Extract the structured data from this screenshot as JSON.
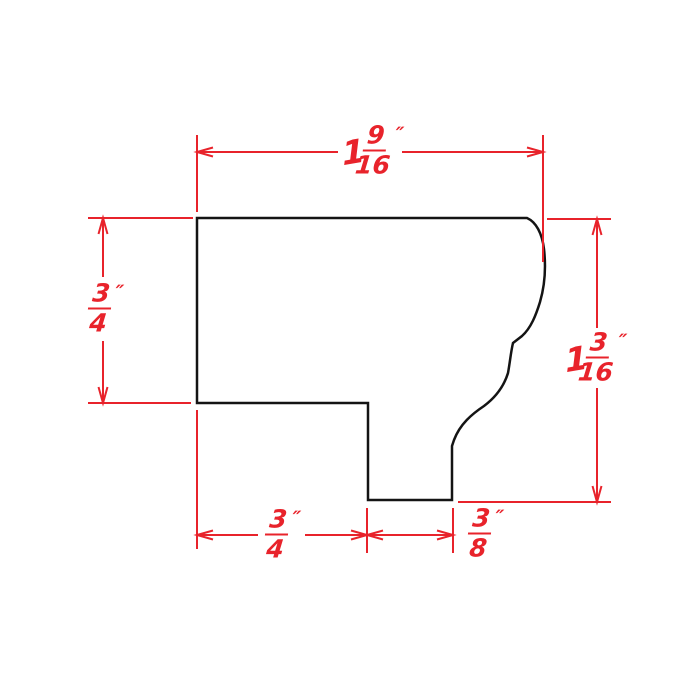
{
  "diagram": {
    "type": "molding-profile-dimension-drawing",
    "colors": {
      "dimension_red": "#e8232b",
      "profile_black": "#141414",
      "background": "#ffffff"
    },
    "dimensions": {
      "top_width": {
        "whole": "1",
        "numerator": "9",
        "denominator": "16",
        "unit": "″"
      },
      "left_height": {
        "whole": "",
        "numerator": "3",
        "denominator": "4",
        "unit": "″"
      },
      "right_height": {
        "whole": "1",
        "numerator": "3",
        "denominator": "16",
        "unit": "″"
      },
      "bottom_left_width": {
        "whole": "",
        "numerator": "3",
        "denominator": "4",
        "unit": "″"
      },
      "bottom_right_width": {
        "whole": "",
        "numerator": "3",
        "denominator": "8",
        "unit": "″"
      }
    }
  }
}
